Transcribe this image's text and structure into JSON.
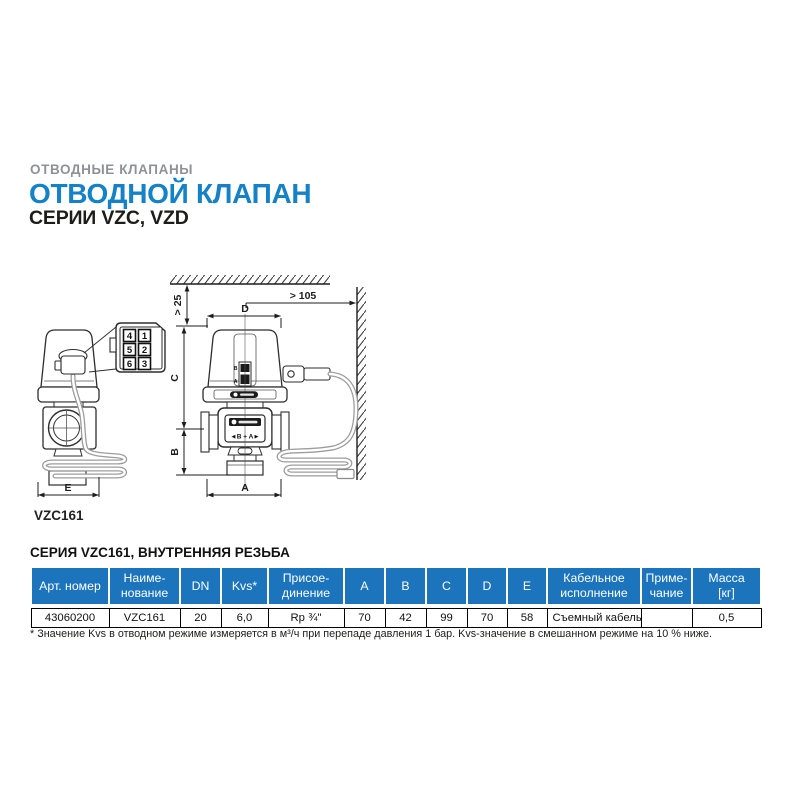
{
  "header": {
    "kicker": "ОТВОДНЫЕ КЛАПАНЫ",
    "title": "ОТВОДНОЙ КЛАПАН",
    "subtitle": "СЕРИИ VZC, VZD"
  },
  "drawing": {
    "model_label": "VZC161",
    "dims": {
      "top_clearance": "> 25",
      "wall_clearance": "> 105",
      "d": "D",
      "c": "C",
      "b": "B",
      "a": "A",
      "e": "E"
    },
    "pinout_pins": [
      "4",
      "1",
      "5",
      "2",
      "6",
      "3"
    ],
    "markings": {
      "indicator_top": "B",
      "indicator_bottom": "A",
      "body_label": "◄B + A►"
    }
  },
  "section_title": "СЕРИЯ VZC161, ВНУТРЕННЯЯ РЕЗЬБА",
  "table": {
    "headers": [
      "Арт. номер",
      "Наиме-\nнование",
      "DN",
      "Kvs*",
      "Присое-\nдинение",
      "A",
      "B",
      "C",
      "D",
      "E",
      "Кабельное\nисполнение",
      "Приме-\nчание",
      "Масса\n[кг]"
    ],
    "rows": [
      [
        "43060200",
        "VZC161",
        "20",
        "6,0",
        "Rp ¾\"",
        "70",
        "42",
        "99",
        "70",
        "58",
        "Съемный кабель",
        "",
        "0,5"
      ]
    ],
    "footnote": "* Значение Kvs в отводном режиме измеряется в м³/ч при перепаде давления 1 бар. Kvs-значение в смешанном режиме на 10 % ниже."
  },
  "colors": {
    "accent_blue_title": "#1581c6",
    "table_header_blue": "#1c75bc",
    "kicker_gray": "#8e9296"
  }
}
